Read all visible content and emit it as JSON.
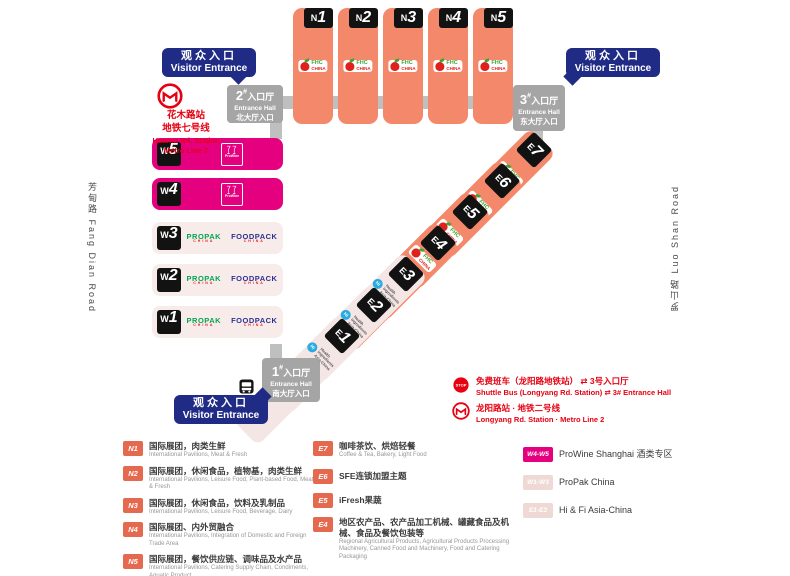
{
  "map": {
    "visitor_entrance": {
      "zh": "观众入口",
      "en": "Visitor Entrance"
    },
    "north_halls": [
      {
        "prefix": "N",
        "num": "1"
      },
      {
        "prefix": "N",
        "num": "2"
      },
      {
        "prefix": "N",
        "num": "3"
      },
      {
        "prefix": "N",
        "num": "4"
      },
      {
        "prefix": "N",
        "num": "5"
      }
    ],
    "west_halls": [
      {
        "prefix": "W",
        "num": "5"
      },
      {
        "prefix": "W",
        "num": "4"
      },
      {
        "prefix": "W",
        "num": "3"
      },
      {
        "prefix": "W",
        "num": "2"
      },
      {
        "prefix": "W",
        "num": "1"
      }
    ],
    "east_halls": [
      {
        "prefix": "E",
        "num": "7"
      },
      {
        "prefix": "E",
        "num": "6"
      },
      {
        "prefix": "E",
        "num": "5"
      },
      {
        "prefix": "E",
        "num": "4"
      },
      {
        "prefix": "E",
        "num": "3"
      },
      {
        "prefix": "E",
        "num": "2"
      },
      {
        "prefix": "E",
        "num": "1"
      }
    ],
    "entrance_halls": {
      "h1": {
        "num": "1",
        "hash": "#",
        "hall": "入口厅",
        "en": "Entrance Hall",
        "sub": "南大厅入口"
      },
      "h2": {
        "num": "2",
        "hash": "#",
        "hall": "入口厅",
        "en": "Entrance Hall",
        "sub": "北大厅入口"
      },
      "h3": {
        "num": "3",
        "hash": "#",
        "hall": "入口厅",
        "en": "Entrance Hall",
        "sub": "东大厅入口"
      }
    },
    "metro_huamu": {
      "zh1": "花木路站",
      "zh2": "地铁七号线",
      "en1": "Huamu Rd. Station",
      "en2": "Metro Line 7"
    },
    "shuttle": {
      "zh": "免费班车（龙阳路地铁站） ⇄ 3号入口厅",
      "en": "Shuttle Bus (Longyang Rd. Station) ⇄ 3# Entrance Hall"
    },
    "metro_longyang": {
      "zh": "龙阳路站 · 地铁二号线",
      "en": "Longyang Rd. Station · Metro Line 2"
    },
    "roads": {
      "west": "芳甸路 Fang Dian Road",
      "east": "罗山路 Luo Shan Road"
    },
    "stop_label": "STOP"
  },
  "brands": {
    "fhc": {
      "l1": "FHC",
      "l2": "CHINA"
    },
    "prowine": "ProWine",
    "propak": {
      "l1": "PROPAK",
      "l2": "CHINA"
    },
    "foodpack": {
      "l1": "FOODPACK",
      "l2": "CHINA"
    },
    "sfe": "SFE",
    "ifresh": "iFresh",
    "came": "CAME",
    "foodprex": "FOODPREX",
    "hi": {
      "abbr": "Hi",
      "l1": "Health ingredients",
      "l2": "Asia-China"
    },
    "fi": {
      "abbr": "Fi",
      "l1": "Food ingredients",
      "l2": "Asia-China"
    }
  },
  "legend": {
    "col1": [
      {
        "key": "N1",
        "zh": "国际展团，肉类生鲜",
        "en": "International Pavilions, Meat & Fresh"
      },
      {
        "key": "N2",
        "zh": "国际展团，休闲食品，植物基，肉类生鲜",
        "en": "International Pavilions, Leisure Food, Plant-based Food, Meat & Fresh"
      },
      {
        "key": "N3",
        "zh": "国际展团，休闲食品，饮料及乳制品",
        "en": "International Pavilions, Leisure Food, Beverage, Dairy"
      },
      {
        "key": "N4",
        "zh": "国际展团、内外贸融合",
        "en": "International Pavilions, Integration of Domestic and Foreign Trade Area"
      },
      {
        "key": "N5",
        "zh": "国际展团，餐饮供应链、调味品及水产品",
        "en": "International Pavilions, Catering Supply Chain, Condiments, Aquatic Product"
      }
    ],
    "col2": [
      {
        "key": "E7",
        "zh": "咖啡茶饮、烘焙轻餐",
        "en": "Coffee & Tea, Bakery, Light Food"
      },
      {
        "key": "E6",
        "zh": "SFE连锁加盟主题",
        "en": ""
      },
      {
        "key": "E5",
        "zh": "iFresh果蔬",
        "en": ""
      },
      {
        "key": "E4",
        "zh": "地区农产品、农产品加工机械、罐藏食品及机械、食品及餐饮包装等",
        "en": "Regional Agricultural Products, Agricultural Products Processing Machinery, Canned Food and Machinery, Food and Catering Packaging"
      }
    ],
    "col3": [
      {
        "key": "W4-W5",
        "label": "ProWine Shanghai 酒类专区"
      },
      {
        "key": "W1-W3",
        "label": "ProPak China"
      },
      {
        "key": "E1-E3",
        "label": "Hi & Fi Asia-China"
      }
    ]
  },
  "colors": {
    "hall_orange": "#f4886b",
    "brand_magenta": "#e4007e",
    "hall_pink": "#f5e6e6",
    "entrance_navy": "#202b85",
    "metro_red": "#e60012",
    "legend_red": "#e4694e",
    "corridor_gray": "#bfbfbf"
  }
}
